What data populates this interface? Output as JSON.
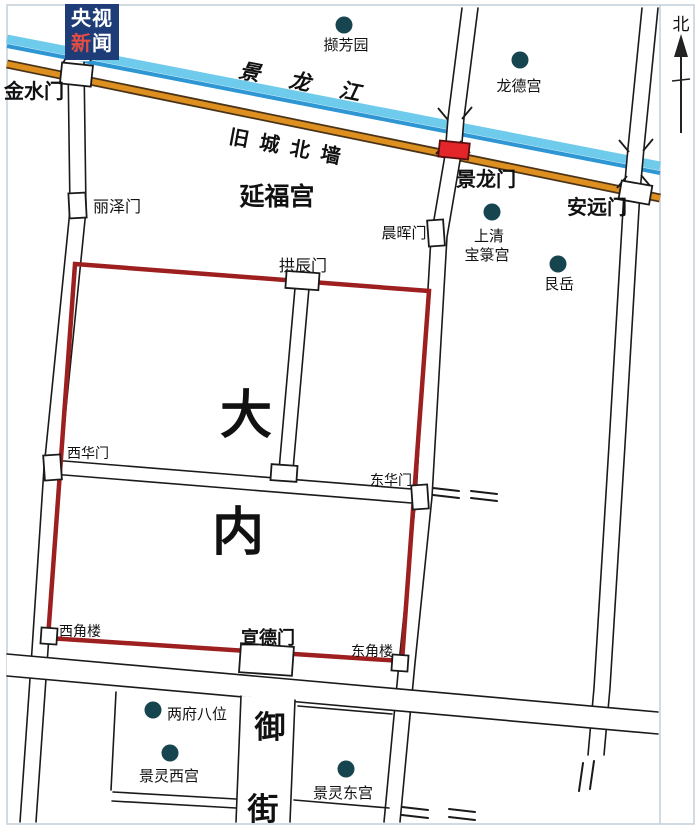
{
  "watermark": {
    "line1": "央视",
    "line2_accent": "新",
    "line2_rest": "闻"
  },
  "compass": {
    "north_label": "北"
  },
  "map": {
    "river": {
      "name": "景龙江"
    },
    "city_wall": {
      "name": "旧城北墙"
    },
    "palace": {
      "name_char1": "大",
      "name_char2": "内"
    },
    "gates": {
      "jinshui": "金水门",
      "lize": "丽泽门",
      "chenhui": "晨晖门",
      "gongchen": "拱辰门",
      "jinglong": "景龙门",
      "anyuan": "安远门",
      "xihua": "西华门",
      "donghua": "东华门",
      "xuande": "宣德门"
    },
    "towers": {
      "xijiaolou": "西角楼",
      "dongjiaolou": "东角楼"
    },
    "sites": {
      "xiefangyuan": "撷芳园",
      "longdegong": "龙德宫",
      "yanfugong": "延福宫",
      "shangqing_line1": "上清",
      "shangqing_line2": "宝箓宫",
      "genyue": "艮岳",
      "liangfubawei": "两府八位",
      "jinglingxigong": "景灵西宫",
      "jinglingdonggong": "景灵东宫"
    },
    "street": {
      "yujie_char1": "御",
      "yujie_char2": "街"
    }
  },
  "colors": {
    "river_light": "#6FCBEC",
    "river_dark": "#2E97D3",
    "river_text": "#1E7FC0",
    "wall_fill": "#DD8F1F",
    "wall_edge": "#4A3318",
    "wall_text": "#C8830F",
    "palace_wall": "#9E1F1F",
    "jinglong_gate_fill": "#E3262A",
    "jinglong_text": "#C01820",
    "dot": "#16454F",
    "logo_bg": "#1E3C78",
    "logo_accent": "#E34D43",
    "frame": "#C3CED8"
  }
}
